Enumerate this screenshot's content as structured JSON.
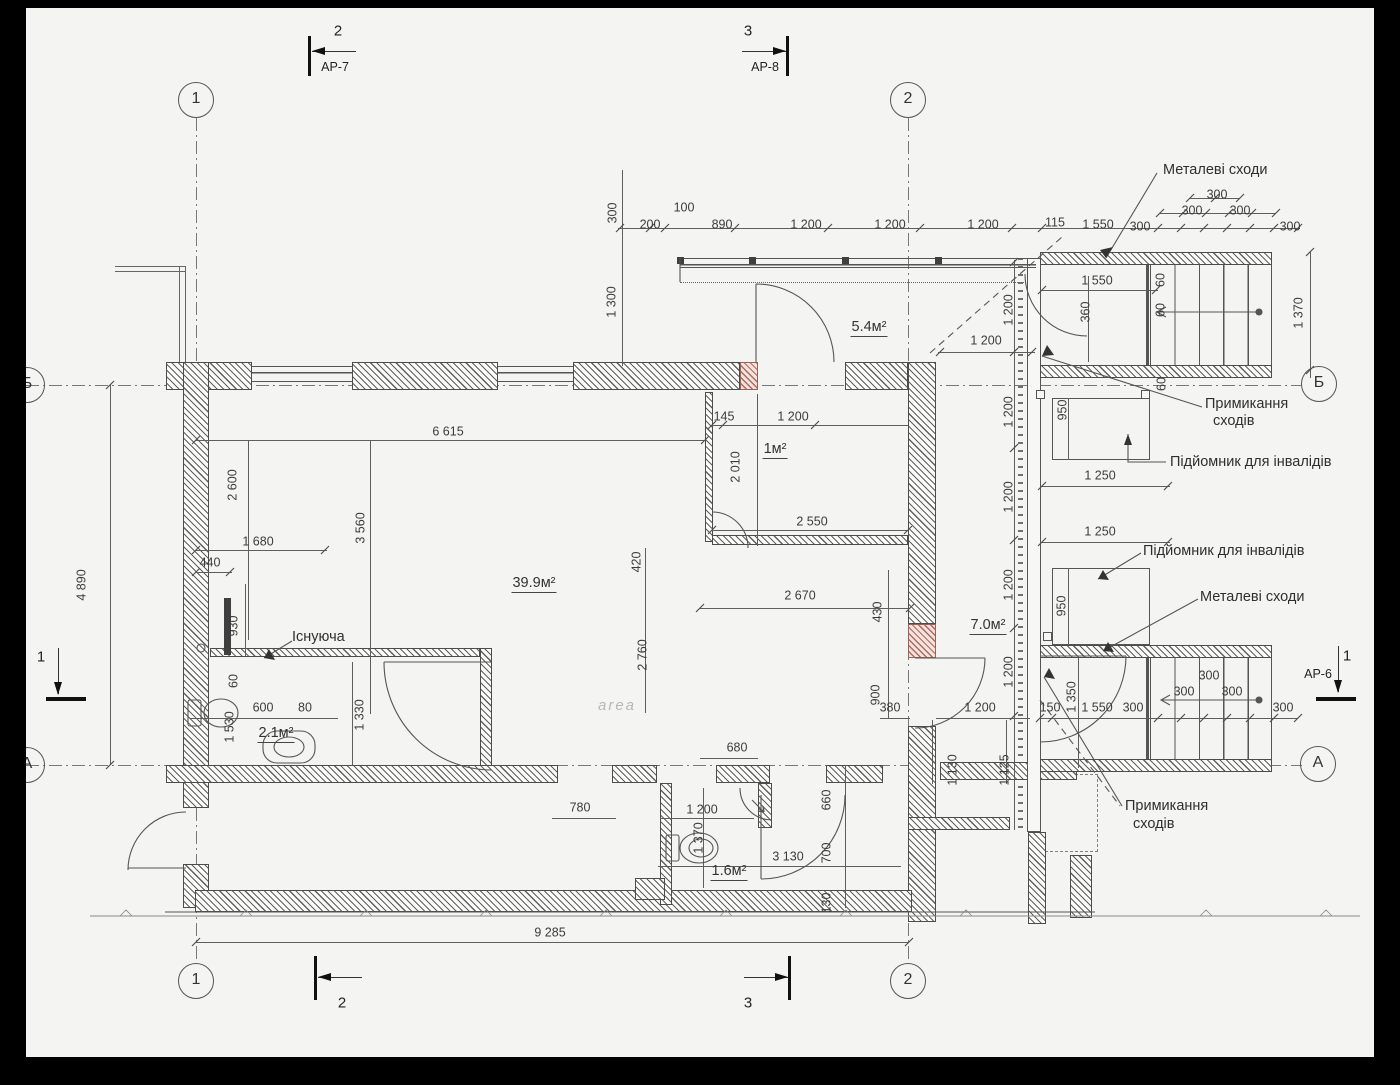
{
  "palette": {
    "paper": "#f4f4f2",
    "ink": "#3d3d3d",
    "dim_line": "#5e5e5e",
    "red_wall": "#b06a60",
    "bar": "#000000"
  },
  "watermark": "area",
  "grid_bubbles": [
    {
      "label": "1",
      "x": 196,
      "y": 100
    },
    {
      "label": "2",
      "x": 908,
      "y": 100
    },
    {
      "label": "1",
      "x": 196,
      "y": 981
    },
    {
      "label": "2",
      "x": 908,
      "y": 981
    },
    {
      "label": "Б",
      "x": 27,
      "y": 385
    },
    {
      "label": "Б",
      "x": 1319,
      "y": 384
    },
    {
      "label": "А",
      "x": 27,
      "y": 765
    },
    {
      "label": "А",
      "x": 1318,
      "y": 764
    }
  ],
  "section_markers": {
    "top_left": {
      "num": "2",
      "ref": "АР-7"
    },
    "top_right": {
      "num": "3",
      "ref": "АР-8"
    },
    "bottom_left": {
      "num": "2"
    },
    "bottom_right": {
      "num": "3"
    },
    "side_left": {
      "num": "1"
    },
    "side_right": {
      "num": "1",
      "ref": "АР-6"
    }
  },
  "annotations": [
    {
      "text": "Металеві сходи",
      "x": 1163,
      "y": 170
    },
    {
      "text": "Примикання",
      "x": 1205,
      "y": 404
    },
    {
      "text": "сходів",
      "x": 1213,
      "y": 421
    },
    {
      "text": "Підйомник для інвалідів",
      "x": 1170,
      "y": 462
    },
    {
      "text": "Підйомник для інвалідів",
      "x": 1143,
      "y": 551
    },
    {
      "text": "Металеві сходи",
      "x": 1200,
      "y": 597
    },
    {
      "text": "Примикання",
      "x": 1125,
      "y": 806
    },
    {
      "text": "сходів",
      "x": 1133,
      "y": 824
    },
    {
      "text": "Існуюча",
      "x": 292,
      "y": 637
    }
  ],
  "rooms": [
    {
      "text": "5.4м²",
      "x": 869,
      "y": 328
    },
    {
      "text": "1м²",
      "x": 775,
      "y": 450
    },
    {
      "text": "39.9м²",
      "x": 534,
      "y": 584
    },
    {
      "text": "7.0м²",
      "x": 988,
      "y": 626
    },
    {
      "text": "2.1м²",
      "x": 276,
      "y": 734
    },
    {
      "text": "1.6м²",
      "x": 729,
      "y": 872
    }
  ],
  "dims": [
    {
      "t": "300",
      "x": 613,
      "y": 213,
      "r": 1
    },
    {
      "t": "200",
      "x": 650,
      "y": 225
    },
    {
      "t": "100",
      "x": 684,
      "y": 208
    },
    {
      "t": "890",
      "x": 722,
      "y": 225
    },
    {
      "t": "1 200",
      "x": 806,
      "y": 225
    },
    {
      "t": "1 200",
      "x": 890,
      "y": 225
    },
    {
      "t": "1 200",
      "x": 983,
      "y": 225
    },
    {
      "t": "115",
      "x": 1055,
      "y": 223
    },
    {
      "t": "1 550",
      "x": 1098,
      "y": 225
    },
    {
      "t": "300",
      "x": 1140,
      "y": 227
    },
    {
      "t": "300",
      "x": 1192,
      "y": 211
    },
    {
      "t": "300",
      "x": 1217,
      "y": 195
    },
    {
      "t": "300",
      "x": 1240,
      "y": 211
    },
    {
      "t": "300",
      "x": 1290,
      "y": 227
    },
    {
      "t": "1 370",
      "x": 1299,
      "y": 313,
      "r": 1
    },
    {
      "t": "1 300",
      "x": 612,
      "y": 302,
      "r": 1
    },
    {
      "t": "1 550",
      "x": 1097,
      "y": 281
    },
    {
      "t": "360",
      "x": 1086,
      "y": 312,
      "r": 1
    },
    {
      "t": "60",
      "x": 1161,
      "y": 280,
      "r": 1
    },
    {
      "t": "60",
      "x": 1161,
      "y": 310,
      "r": 1
    },
    {
      "t": "60",
      "x": 1162,
      "y": 384,
      "r": 1
    },
    {
      "t": "1 200",
      "x": 986,
      "y": 341
    },
    {
      "t": "1 200",
      "x": 1009,
      "y": 310,
      "r": 1
    },
    {
      "t": "1 200",
      "x": 1009,
      "y": 412,
      "r": 1
    },
    {
      "t": "1 200",
      "x": 1009,
      "y": 497,
      "r": 1
    },
    {
      "t": "1 200",
      "x": 1009,
      "y": 585,
      "r": 1
    },
    {
      "t": "1 200",
      "x": 1009,
      "y": 672,
      "r": 1
    },
    {
      "t": "950",
      "x": 1063,
      "y": 410,
      "r": 1
    },
    {
      "t": "1 250",
      "x": 1100,
      "y": 476
    },
    {
      "t": "1 250",
      "x": 1100,
      "y": 532
    },
    {
      "t": "950",
      "x": 1062,
      "y": 606,
      "r": 1
    },
    {
      "t": "6 615",
      "x": 448,
      "y": 432
    },
    {
      "t": "2 600",
      "x": 233,
      "y": 485,
      "r": 1
    },
    {
      "t": "3 560",
      "x": 361,
      "y": 528,
      "r": 1
    },
    {
      "t": "1 680",
      "x": 258,
      "y": 542
    },
    {
      "t": "440",
      "x": 210,
      "y": 563
    },
    {
      "t": "930",
      "x": 234,
      "y": 626,
      "r": 1
    },
    {
      "t": "4 890",
      "x": 82,
      "y": 585,
      "r": 1
    },
    {
      "t": "60",
      "x": 234,
      "y": 681,
      "r": 1
    },
    {
      "t": "1 530",
      "x": 230,
      "y": 727,
      "r": 1
    },
    {
      "t": "600",
      "x": 263,
      "y": 708
    },
    {
      "t": "80",
      "x": 305,
      "y": 708
    },
    {
      "t": "1 330",
      "x": 360,
      "y": 715,
      "r": 1
    },
    {
      "t": "145",
      "x": 724,
      "y": 417
    },
    {
      "t": "1 200",
      "x": 793,
      "y": 417
    },
    {
      "t": "2 010",
      "x": 736,
      "y": 467,
      "r": 1
    },
    {
      "t": "2 550",
      "x": 812,
      "y": 522
    },
    {
      "t": "420",
      "x": 637,
      "y": 562,
      "r": 1
    },
    {
      "t": "2 760",
      "x": 643,
      "y": 655,
      "r": 1
    },
    {
      "t": "2 670",
      "x": 800,
      "y": 596
    },
    {
      "t": "430",
      "x": 878,
      "y": 612,
      "r": 1
    },
    {
      "t": "900",
      "x": 876,
      "y": 695,
      "r": 1
    },
    {
      "t": "380",
      "x": 890,
      "y": 708
    },
    {
      "t": "1 200",
      "x": 980,
      "y": 708
    },
    {
      "t": "150",
      "x": 1050,
      "y": 708
    },
    {
      "t": "1 350",
      "x": 1072,
      "y": 697,
      "r": 1
    },
    {
      "t": "1 550",
      "x": 1097,
      "y": 708
    },
    {
      "t": "300",
      "x": 1133,
      "y": 708
    },
    {
      "t": "300",
      "x": 1184,
      "y": 692
    },
    {
      "t": "300",
      "x": 1209,
      "y": 676
    },
    {
      "t": "300",
      "x": 1232,
      "y": 692
    },
    {
      "t": "300",
      "x": 1283,
      "y": 708
    },
    {
      "t": "1 130",
      "x": 953,
      "y": 770,
      "r": 1
    },
    {
      "t": "1 125",
      "x": 1005,
      "y": 770,
      "r": 1
    },
    {
      "t": "680",
      "x": 737,
      "y": 748
    },
    {
      "t": "780",
      "x": 580,
      "y": 808
    },
    {
      "t": "1 200",
      "x": 702,
      "y": 810
    },
    {
      "t": "1 370",
      "x": 699,
      "y": 838,
      "r": 1
    },
    {
      "t": "660",
      "x": 827,
      "y": 800,
      "r": 1
    },
    {
      "t": "700",
      "x": 827,
      "y": 853,
      "r": 1
    },
    {
      "t": "3 130",
      "x": 788,
      "y": 857
    },
    {
      "t": "130",
      "x": 827,
      "y": 903,
      "r": 1
    },
    {
      "t": "9 285",
      "x": 550,
      "y": 933
    }
  ]
}
